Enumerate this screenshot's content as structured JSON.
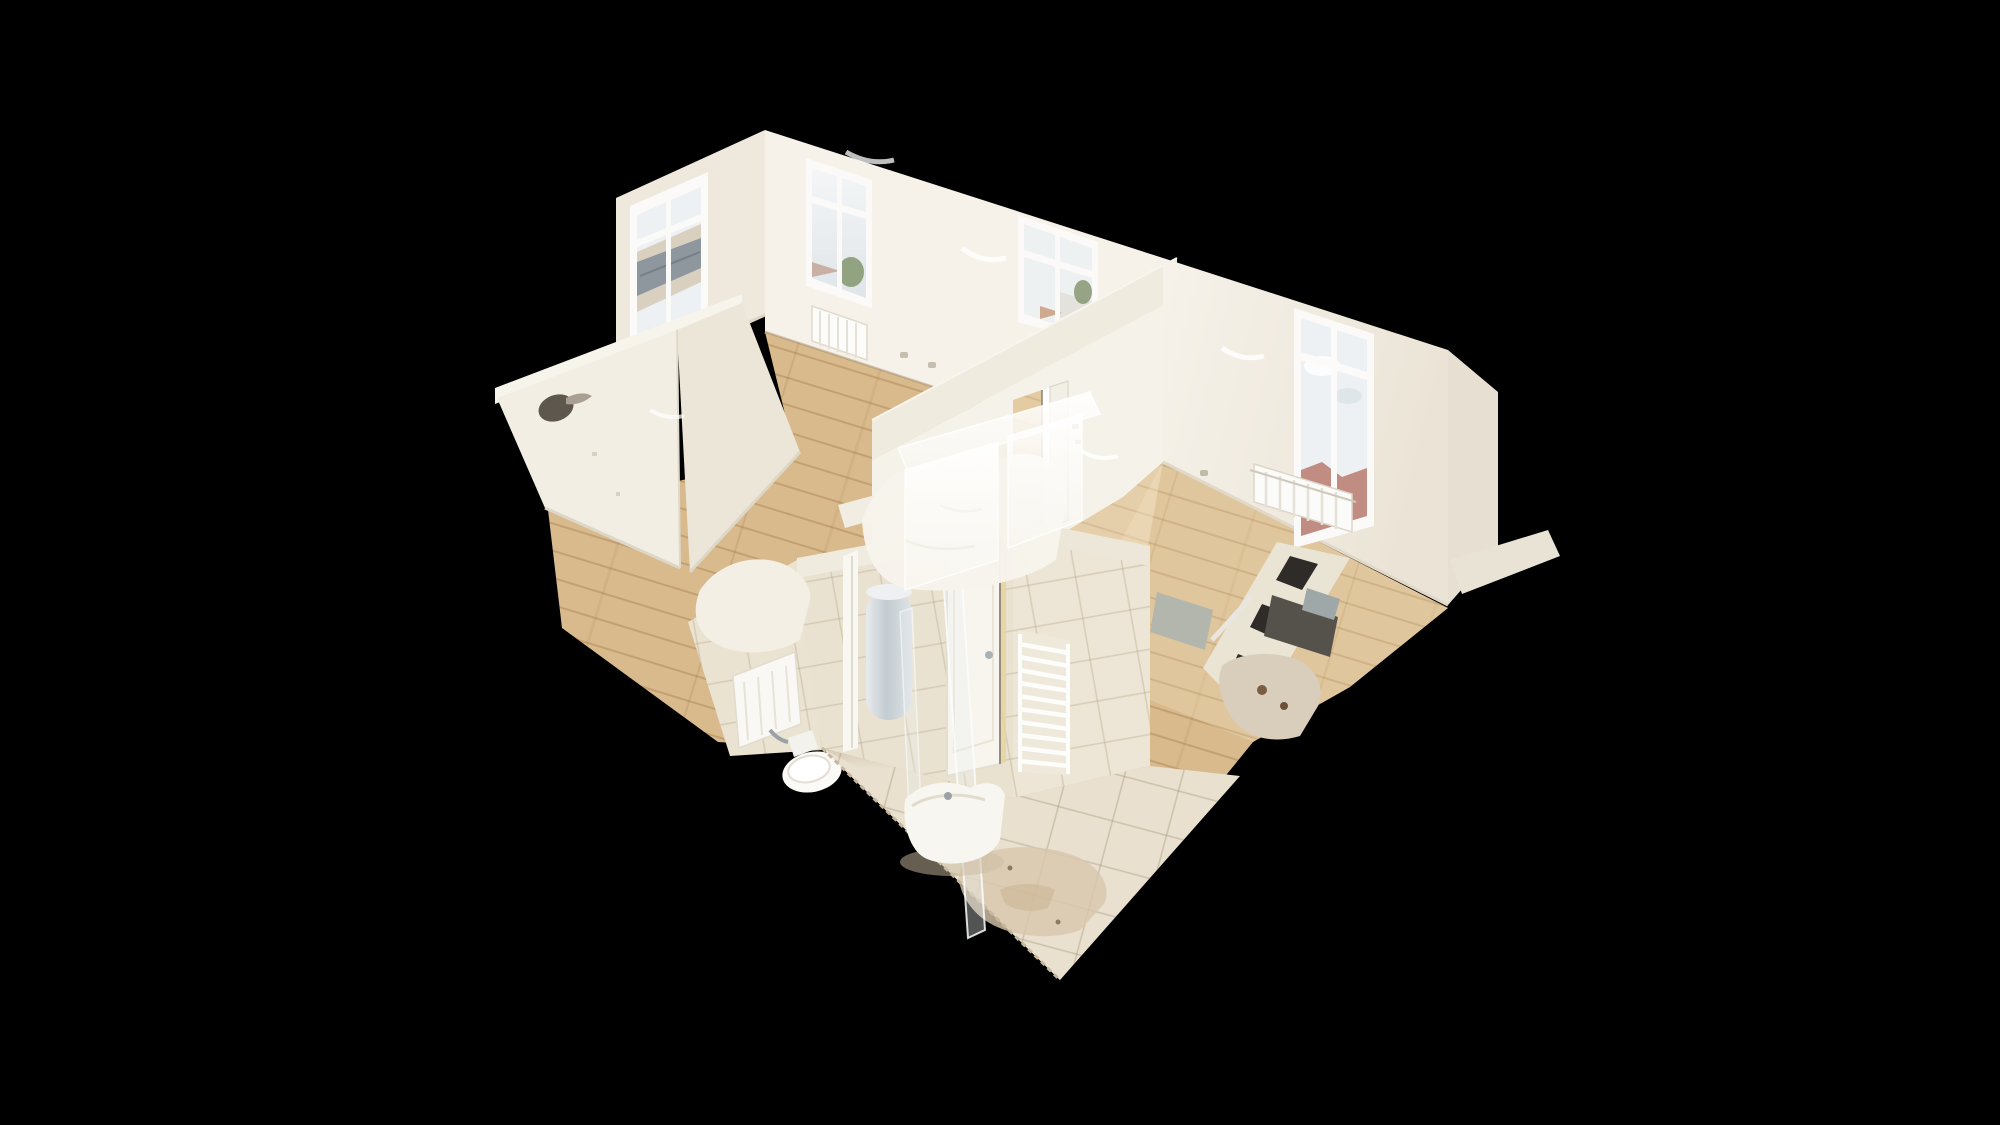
{
  "app": {
    "name": "3d-virtual-tour-viewer",
    "view_mode": "dollhouse-cutaway",
    "content": "empty renovated apartment 3D scan on black viewport, no UI chrome visible"
  },
  "scene": {
    "rooms": [
      {
        "name": "living-room",
        "position": "top-left",
        "features": [
          "left wall window with metal-roof view",
          "two back wall windows with sky/tree view",
          "panel radiator under each window",
          "white walls",
          "light oak floor",
          "power outlets",
          "ceiling light scan smudges"
        ]
      },
      {
        "name": "bedroom",
        "position": "right",
        "features": [
          "window with cloudy sky and red rooftops view",
          "white panel radiator below window",
          "white walls",
          "light oak floor",
          "power outlet",
          "low cut wall fragment at far right"
        ]
      },
      {
        "name": "empty-room",
        "position": "center-left",
        "features": [
          "bright white walls",
          "dark scan hole artifact in wall",
          "light oak floor"
        ]
      },
      {
        "name": "hallway",
        "position": "center",
        "features": [
          "dividing wall with open doorway",
          "white door leaf",
          "frosted half-scanned wall slabs",
          "wood floor"
        ]
      },
      {
        "name": "bathroom",
        "position": "center-bottom",
        "features": [
          "beige tiled walls",
          "white door with metal handle",
          "white towel ladder radiator",
          "glass shower panels",
          "white sink vanity",
          "toilet",
          "gray water-heater cylinder",
          "beige tile floor with stain patch"
        ]
      },
      {
        "name": "kitchen-corner",
        "position": "center-right",
        "features": [
          "dark appliance fragments",
          "chrome/mirror streaked counter fragment",
          "gray slab artifacts",
          "torn mesh geometry"
        ]
      }
    ],
    "artifacts": [
      "torn photogrammetry mesh edges",
      "translucent wall fragments",
      "serrated floor edge",
      "hole in left room wall"
    ]
  },
  "palette": {
    "background": "#000000",
    "wall_bright": "#f6f2ea",
    "wall_face": "#f5f2ea",
    "wall_base": "#efe9dd",
    "wall_shade": "#e7e0d2",
    "band": "#f0ebdf",
    "band2": "#ede7da",
    "left_wall": "#f2eee4",
    "left_wall_shade": "#ece6d9",
    "bedroom_wall": "#f4f0e8",
    "low_wall": "#e9e3d5",
    "tile_wall": "#eae2d1",
    "tile_wall2": "#ede5d5",
    "tile_floor": "#e9e0cf",
    "wood_base": "#d8ba8c",
    "door_white": "#f8f5ef",
    "frame_white": "#fbfaf8",
    "glass_sky": "#edf1f3",
    "roof_gray": "#8e969e",
    "facade_beige": "#d9d0c0",
    "tree_green": "#7f9169",
    "roof_red": "#b2695c",
    "artifact_dark": "#55524c",
    "artifact_gray": "#b3b6ac",
    "chrome": "#9aa2a8",
    "stain": "#d9c7ac",
    "heater_gray": "#ccd3d7",
    "white_blob": "#f7f4ec"
  }
}
